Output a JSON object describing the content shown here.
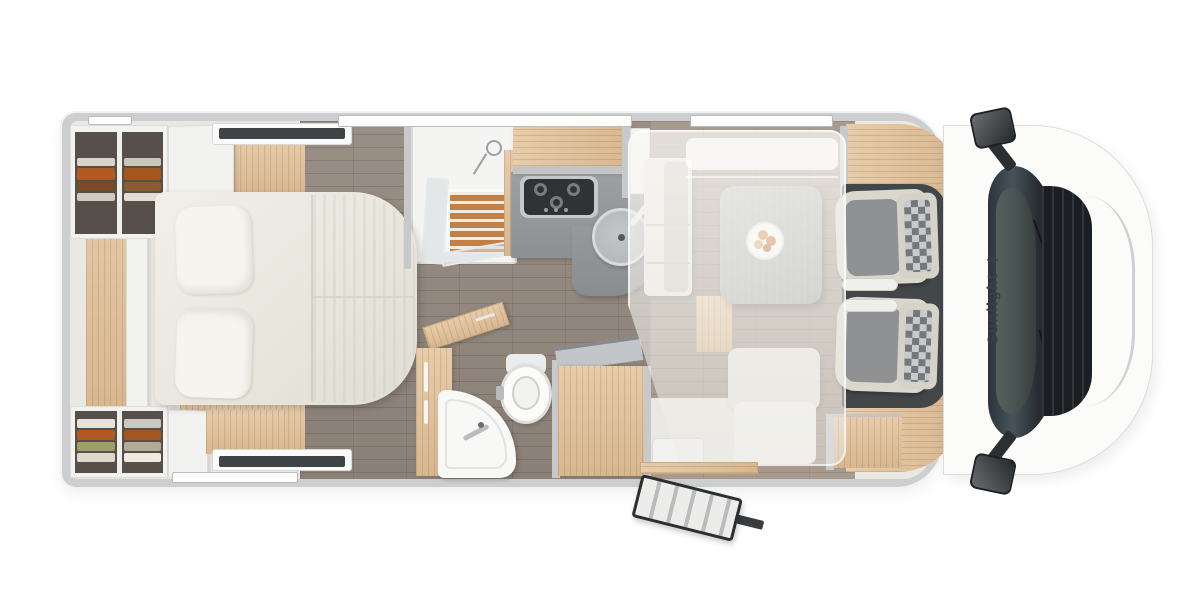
{
  "brand": {
    "name": "Sunlight",
    "logo_glyph": "✳"
  },
  "scene": {
    "description": "Motorhome floor plan, top-down 3D view, rear bedroom at left, driver cab at right"
  },
  "colors": {
    "body_wall": "#ccced0",
    "floor_plank": "#93887e",
    "floor_cream": "#eae8e2",
    "furniture_wood": "#e2c198",
    "upholstery_cream": "#e9e6dd",
    "kitchen_counter": "#96999b",
    "cab_floor": "#44474a",
    "windshield_glass": "#39434a",
    "brand_text": "#3a3f44",
    "clothes_orange": "#b05a22"
  },
  "furniture_icons": [
    "double-bed-icon",
    "pillow-icon",
    "wardrobe-icon",
    "shower-icon",
    "gas-hob-icon",
    "kitchen-sink-icon",
    "dinette-table-icon",
    "bench-seat-icon",
    "drop-down-bed-icon",
    "toilet-icon",
    "washbasin-icon",
    "entry-door-icon",
    "entry-step-icon",
    "captain-seat-icon",
    "side-mirror-icon",
    "window-icon",
    "rooflight-icon"
  ]
}
